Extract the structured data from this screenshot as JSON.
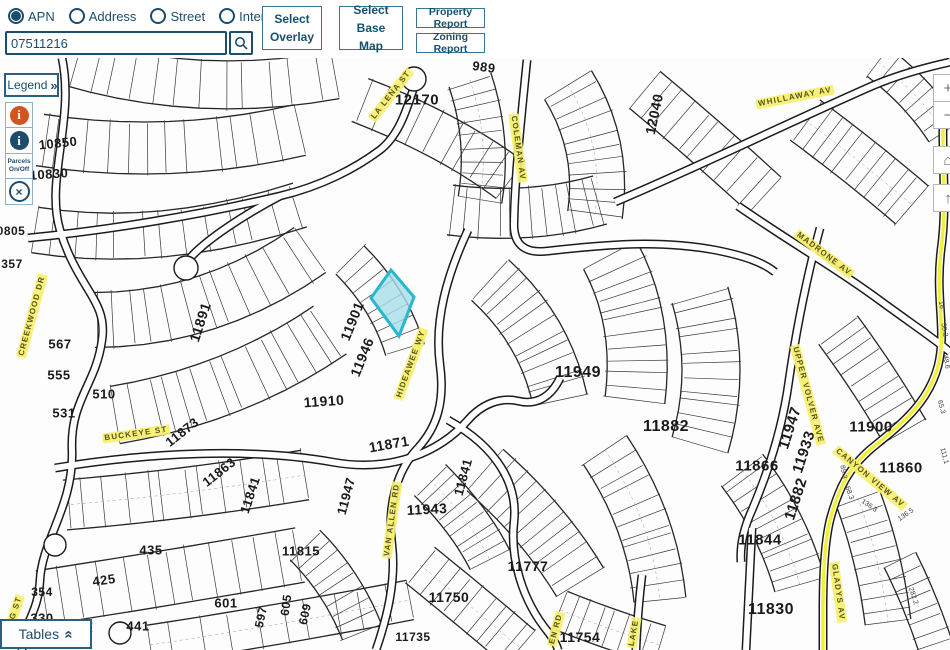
{
  "toolbar": {
    "search_modes": [
      {
        "label": "APN",
        "selected": true
      },
      {
        "label": "Address",
        "selected": false
      },
      {
        "label": "Street",
        "selected": false
      },
      {
        "label": "Intersection",
        "selected": false
      }
    ],
    "search_value": "07511216",
    "select_overlay_label": "Select Overlay",
    "select_base_map_label": "Select Base Map",
    "property_report_label": "Property Report",
    "zoning_report_label": "Zoning Report"
  },
  "side_panel": {
    "legend_label": "Legend",
    "legend_chevrons": "»",
    "info_orange_glyph": "i",
    "info_blue_glyph": "i",
    "parcels_toggle_line1": "Parcels",
    "parcels_toggle_line2": "On/Off",
    "clear_glyph": "×",
    "tables_label": "Tables",
    "tables_chevrons": "«"
  },
  "map_controls": {
    "zoom_in": "+",
    "zoom_out": "−",
    "home_glyph": "⌂",
    "north_glyph": "↑"
  },
  "colors": {
    "accent": "#1d4d6d",
    "button_border": "#3a7391",
    "info_orange": "#d2541f",
    "street_label_bg": "#f7f06e",
    "parcel_highlight_fill": "#a5dde9",
    "parcel_highlight_stroke": "#2ab6cf",
    "road_highlight": "#f1ef3c"
  },
  "map": {
    "parcel_labels": [
      {
        "text": "10850",
        "x": 58,
        "y": 143,
        "size": 13,
        "rot": -6
      },
      {
        "text": "10830",
        "x": 49,
        "y": 174,
        "size": 13,
        "rot": -4
      },
      {
        "text": "0805",
        "x": 11,
        "y": 231,
        "size": 12,
        "rot": 0
      },
      {
        "text": "357",
        "x": 12,
        "y": 264,
        "size": 12,
        "rot": 0
      },
      {
        "text": "567",
        "x": 60,
        "y": 344,
        "size": 13,
        "rot": 0
      },
      {
        "text": "555",
        "x": 59,
        "y": 375,
        "size": 13,
        "rot": 0
      },
      {
        "text": "531",
        "x": 64,
        "y": 413,
        "size": 13,
        "rot": 0
      },
      {
        "text": "510",
        "x": 104,
        "y": 394,
        "size": 13,
        "rot": 0
      },
      {
        "text": "11891",
        "x": 200,
        "y": 322,
        "size": 14,
        "rot": -72
      },
      {
        "text": "11873",
        "x": 182,
        "y": 432,
        "size": 13,
        "rot": -38
      },
      {
        "text": "11863",
        "x": 219,
        "y": 472,
        "size": 13,
        "rot": -38
      },
      {
        "text": "11841",
        "x": 250,
        "y": 495,
        "size": 13,
        "rot": -72
      },
      {
        "text": "435",
        "x": 151,
        "y": 550,
        "size": 13,
        "rot": 0
      },
      {
        "text": "425",
        "x": 104,
        "y": 580,
        "size": 13,
        "rot": -8
      },
      {
        "text": "354",
        "x": 42,
        "y": 592,
        "size": 12,
        "rot": 0
      },
      {
        "text": "330",
        "x": 42,
        "y": 618,
        "size": 13,
        "rot": 0
      },
      {
        "text": "417",
        "x": 83,
        "y": 630,
        "size": 14,
        "rot": -22
      },
      {
        "text": "441",
        "x": 138,
        "y": 626,
        "size": 13,
        "rot": 0
      },
      {
        "text": "601",
        "x": 226,
        "y": 603,
        "size": 13,
        "rot": 0
      },
      {
        "text": "597",
        "x": 261,
        "y": 617,
        "size": 12,
        "rot": -78
      },
      {
        "text": "605",
        "x": 286,
        "y": 605,
        "size": 12,
        "rot": -82
      },
      {
        "text": "609",
        "x": 305,
        "y": 614,
        "size": 12,
        "rot": -78
      },
      {
        "text": "11815",
        "x": 301,
        "y": 551,
        "size": 13,
        "rot": 0
      },
      {
        "text": "11901",
        "x": 352,
        "y": 321,
        "size": 14,
        "rot": -68
      },
      {
        "text": "11946",
        "x": 362,
        "y": 357,
        "size": 14,
        "rot": -68
      },
      {
        "text": "11910",
        "x": 324,
        "y": 401,
        "size": 14,
        "rot": -4
      },
      {
        "text": "11871",
        "x": 389,
        "y": 444,
        "size": 14,
        "rot": -10
      },
      {
        "text": "11947",
        "x": 346,
        "y": 496,
        "size": 13,
        "rot": -75
      },
      {
        "text": "11943",
        "x": 427,
        "y": 509,
        "size": 14,
        "rot": -3
      },
      {
        "text": "11841",
        "x": 463,
        "y": 477,
        "size": 13,
        "rot": -75
      },
      {
        "text": "11735",
        "x": 413,
        "y": 637,
        "size": 12,
        "rot": 0
      },
      {
        "text": "11750",
        "x": 449,
        "y": 597,
        "size": 14,
        "rot": 0
      },
      {
        "text": "11777",
        "x": 528,
        "y": 566,
        "size": 14,
        "rot": 0
      },
      {
        "text": "11754",
        "x": 580,
        "y": 637,
        "size": 14,
        "rot": 0
      },
      {
        "text": "11949",
        "x": 578,
        "y": 373,
        "size": 16,
        "rot": 0
      },
      {
        "text": "11882",
        "x": 666,
        "y": 427,
        "size": 16,
        "rot": 0
      },
      {
        "text": "11866",
        "x": 757,
        "y": 466,
        "size": 15,
        "rot": 0
      },
      {
        "text": "11947",
        "x": 790,
        "y": 428,
        "size": 15,
        "rot": -72
      },
      {
        "text": "11933",
        "x": 804,
        "y": 452,
        "size": 15,
        "rot": -72
      },
      {
        "text": "11882",
        "x": 796,
        "y": 499,
        "size": 15,
        "rot": -72
      },
      {
        "text": "11844",
        "x": 760,
        "y": 540,
        "size": 15,
        "rot": 0
      },
      {
        "text": "11830",
        "x": 771,
        "y": 610,
        "size": 16,
        "rot": 0
      },
      {
        "text": "11900",
        "x": 871,
        "y": 427,
        "size": 15,
        "rot": 0
      },
      {
        "text": "11860",
        "x": 901,
        "y": 468,
        "size": 15,
        "rot": 0
      },
      {
        "text": "12170",
        "x": 417,
        "y": 100,
        "size": 15,
        "rot": 0
      },
      {
        "text": "12040",
        "x": 654,
        "y": 114,
        "size": 14,
        "rot": -78
      },
      {
        "text": "989",
        "x": 484,
        "y": 67,
        "size": 13,
        "rot": 8
      }
    ],
    "street_labels": [
      {
        "text": "CREEKWOOD DR",
        "x": 32,
        "y": 316,
        "rot": -75
      },
      {
        "text": "BUCKEYE ST",
        "x": 136,
        "y": 434,
        "rot": -8
      },
      {
        "text": "G ST",
        "x": 16,
        "y": 608,
        "rot": -72
      },
      {
        "text": "LA LENA ST",
        "x": 391,
        "y": 95,
        "rot": -52
      },
      {
        "text": "COLEMAN AV",
        "x": 518,
        "y": 148,
        "rot": 82
      },
      {
        "text": "WHILLAWAY AV",
        "x": 795,
        "y": 97,
        "rot": -11
      },
      {
        "text": "MADRONE AV",
        "x": 824,
        "y": 254,
        "rot": 37
      },
      {
        "text": "UPPER VOLVER AVE",
        "x": 808,
        "y": 395,
        "rot": 75
      },
      {
        "text": "CANYON VIEW AV",
        "x": 870,
        "y": 478,
        "rot": 40
      },
      {
        "text": "GLADYS AV",
        "x": 838,
        "y": 592,
        "rot": 82
      },
      {
        "text": "VAN ALLEN RD",
        "x": 392,
        "y": 520,
        "rot": -82
      },
      {
        "text": "HIDEAWEE WY",
        "x": 411,
        "y": 364,
        "rot": -70
      },
      {
        "text": "EN RD",
        "x": 556,
        "y": 629,
        "rot": -75
      },
      {
        "text": "LAKE",
        "x": 634,
        "y": 633,
        "rot": -80
      }
    ],
    "dimension_labels": [
      {
        "text": "65.3",
        "x": 941,
        "y": 407,
        "rot": 75
      },
      {
        "text": "111.1",
        "x": 944,
        "y": 456,
        "rot": 75
      },
      {
        "text": "136.3",
        "x": 869,
        "y": 506,
        "rot": 35
      },
      {
        "text": "136.5",
        "x": 906,
        "y": 515,
        "rot": -35
      },
      {
        "text": "68.3",
        "x": 849,
        "y": 493,
        "rot": 70
      },
      {
        "text": "89.3",
        "x": 843,
        "y": 472,
        "rot": 80
      },
      {
        "text": "50.2",
        "x": 944,
        "y": 330,
        "rot": 80
      },
      {
        "text": "48.6",
        "x": 946,
        "y": 362,
        "rot": 80
      },
      {
        "text": "16",
        "x": 941,
        "y": 305,
        "rot": 80
      },
      {
        "text": "282.2",
        "x": 913,
        "y": 596,
        "rot": 72
      }
    ]
  }
}
